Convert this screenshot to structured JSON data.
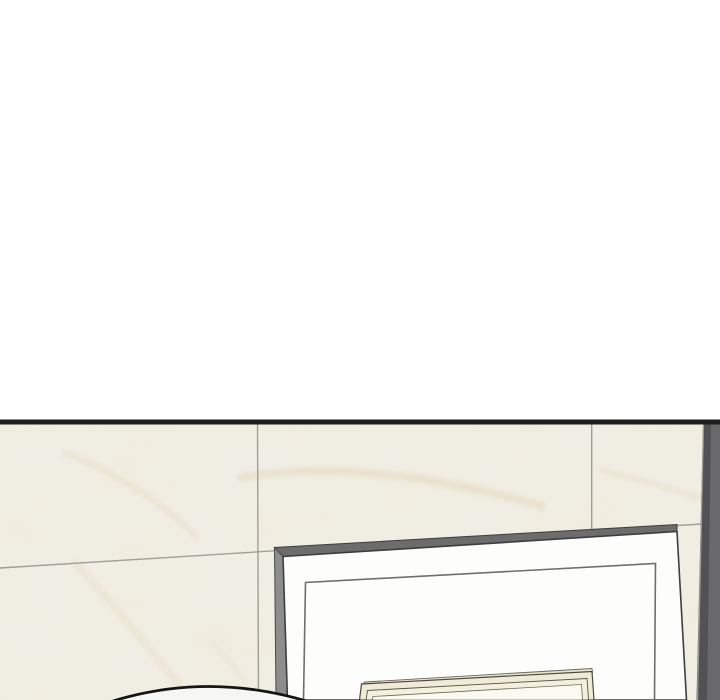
{
  "meta": {
    "description": "Webtoon-style comic panel: blank white gutter above a black panel border; below, a cream marble-tiled wall with a dark wall-corner strip on the right, a large white board with grey edges leaning against the wall, a cream picture frame rising from the bottom, and the top of a character's head entering from the bottom-left edge.",
    "width_px": 720,
    "height_px": 700
  },
  "palette": {
    "gutter_white": "#ffffff",
    "panel_border_black": "#1d1d1d",
    "marble_base": "#f0ede4",
    "marble_vein_tan": "#e2d7ba",
    "grout_grey": "#a09f96",
    "corner_strip_dark": "#525255",
    "corner_strip_light": "#69696c",
    "corner_strip_highlight": "#9c9c98",
    "board_top_edge_grey": "#6c6c6c",
    "board_side_grey": "#8d8d8d",
    "board_face_white": "#fdfdfb",
    "board_outline": "#3e3e3e",
    "board_inner_line": "#6e6e6e",
    "frame_cream": "#efebd6",
    "frame_top_face": "#e6e3ce",
    "frame_line_dark": "#4d4b41",
    "frame_inner_white": "#fbfaf1",
    "head_fill": "#f6f6f4",
    "head_outline": "#151515"
  },
  "scene": {
    "layers": [
      {
        "name": "gutter-top",
        "type": "rect",
        "attrs": {
          "x": 0,
          "y": 0,
          "width": 720,
          "height": 420,
          "fill": "#ffffff"
        }
      },
      {
        "name": "panel-top-border",
        "type": "rect",
        "attrs": {
          "x": 0,
          "y": 419.5,
          "width": 720,
          "height": 5,
          "fill": "#1d1d1d"
        }
      },
      {
        "name": "marble-wall",
        "type": "rect",
        "attrs": {
          "x": 0,
          "y": 424.5,
          "width": 720,
          "height": 275.5,
          "fill": "#f0ede4"
        }
      },
      {
        "name": "marble-wall-veining",
        "type": "rect",
        "attrs": {
          "x": 0,
          "y": 424.5,
          "width": 720,
          "height": 275.5,
          "fill": "#f0ede4",
          "filter": "url(#marble-veins)"
        }
      },
      {
        "name": "marble-vein-streak-1",
        "type": "path",
        "attrs": {
          "d": "M 238,478 C 330,462 430,474 545,507",
          "fill": "none",
          "stroke": "#e2d7ba",
          "stroke-width": 8,
          "opacity": 0.5,
          "filter": "url(#vein-soften)"
        }
      },
      {
        "name": "marble-vein-streak-2",
        "type": "path",
        "attrs": {
          "d": "M 62,452 C 112,470 162,502 198,538",
          "fill": "none",
          "stroke": "#e4dabf",
          "stroke-width": 6,
          "opacity": 0.45,
          "filter": "url(#vein-soften)"
        }
      },
      {
        "name": "marble-vein-streak-3",
        "type": "path",
        "attrs": {
          "d": "M 72,560 C 112,602 152,652 188,696",
          "fill": "none",
          "stroke": "#e4dabf",
          "stroke-width": 7,
          "opacity": 0.38,
          "filter": "url(#vein-soften)"
        }
      },
      {
        "name": "marble-vein-streak-4",
        "type": "path",
        "attrs": {
          "d": "M 600,470 C 642,480 682,492 706,500",
          "fill": "none",
          "stroke": "#e2d7ba",
          "stroke-width": 5,
          "opacity": 0.4,
          "filter": "url(#vein-soften)"
        }
      },
      {
        "name": "marble-vein-streak-5",
        "type": "path",
        "attrs": {
          "d": "M 212,642 C 232,662 246,682 252,698",
          "fill": "none",
          "stroke": "#e4dabf",
          "stroke-width": 5,
          "opacity": 0.3,
          "filter": "url(#vein-soften)"
        }
      },
      {
        "name": "grout-line-horizontal",
        "type": "line",
        "attrs": {
          "x1": 0,
          "y1": 568,
          "x2": 710,
          "y2": 523.5,
          "stroke": "#a09f96",
          "stroke-width": 1.4
        }
      },
      {
        "name": "grout-line-vertical-left",
        "type": "line",
        "attrs": {
          "x1": 257.5,
          "y1": 424.5,
          "x2": 258.5,
          "y2": 700,
          "stroke": "#a09f96",
          "stroke-width": 1.4
        }
      },
      {
        "name": "grout-line-vertical-right",
        "type": "line",
        "attrs": {
          "x1": 591.7,
          "y1": 424.5,
          "x2": 591.7,
          "y2": 529.5,
          "stroke": "#a09f96",
          "stroke-width": 1.4
        }
      },
      {
        "name": "wall-corner-strip",
        "type": "polygon",
        "attrs": {
          "points": "703,424.5 720,424.5 720,700 696.5,700",
          "fill": "#525255"
        }
      },
      {
        "name": "wall-corner-strip-light",
        "type": "polygon",
        "attrs": {
          "points": "711,424.5 720,424.5 720,700 707,700",
          "fill": "#69696c"
        }
      },
      {
        "name": "wall-corner-strip-highlight",
        "type": "line",
        "attrs": {
          "x1": 703.5,
          "y1": 424.5,
          "x2": 697.5,
          "y2": 700,
          "stroke": "#9c9c98",
          "stroke-width": 1.2
        }
      },
      {
        "name": "board-top-edge",
        "type": "polygon",
        "attrs": {
          "points": "274.5,547.5 677,524.5 677,531.5 283,556.5",
          "fill": "#6c6c6c",
          "stroke": "#3e3e3e",
          "stroke-width": 1
        }
      },
      {
        "name": "board-left-edge",
        "type": "polygon",
        "attrs": {
          "points": "274.5,547.5 283,556.5 287.5,700 276,700",
          "fill": "#8d8d8d",
          "stroke": "#4a4a4a",
          "stroke-width": 1
        }
      },
      {
        "name": "board-face",
        "type": "polygon",
        "attrs": {
          "points": "283,556.5 677,531.5 686.5,700 287.5,700",
          "fill": "#fdfdfb",
          "stroke": "#3e3e3e",
          "stroke-width": 1.6
        }
      },
      {
        "name": "board-inner-border",
        "type": "polyline",
        "attrs": {
          "points": "303.5,700 305.5,582.5 655.5,563.5 654.5,700",
          "fill": "none",
          "stroke": "#6e6e6e",
          "stroke-width": 1.6
        }
      },
      {
        "name": "picture-frame-top-face",
        "type": "polygon",
        "attrs": {
          "points": "365,682 592,668.5 592.5,673 362,684.5",
          "fill": "#e6e3ce",
          "stroke": "#6b695b",
          "stroke-width": 0.9
        }
      },
      {
        "name": "picture-frame-outer",
        "type": "polygon",
        "attrs": {
          "points": "361.5,684 592,671.5 594,700 359.5,700",
          "fill": "#efebd6",
          "stroke": "#4d4b41",
          "stroke-width": 1.2
        }
      },
      {
        "name": "picture-frame-step",
        "type": "polygon",
        "attrs": {
          "points": "367.5,690.5 587,678.5 588.5,700 366,700",
          "fill": "#f3f0dd",
          "stroke": "#56544a",
          "stroke-width": 0.9
        }
      },
      {
        "name": "picture-frame-glass",
        "type": "polygon",
        "attrs": {
          "points": "373,696.5 581.5,684.5 582.5,700 372,700",
          "fill": "#fbfaf1",
          "stroke": "#6b695b",
          "stroke-width": 0.8
        }
      },
      {
        "name": "character-head-fill",
        "type": "path",
        "attrs": {
          "d": "M 111.5,701.5 Q 208,671.5 308,701.5 Z",
          "fill": "#f6f6f4"
        }
      },
      {
        "name": "character-head-outline",
        "type": "path",
        "attrs": {
          "d": "M 111.5,701.5 Q 208,671.5 308,701.5",
          "fill": "none",
          "stroke": "#151515",
          "stroke-width": 2.8,
          "stroke-linecap": "round"
        }
      }
    ]
  }
}
